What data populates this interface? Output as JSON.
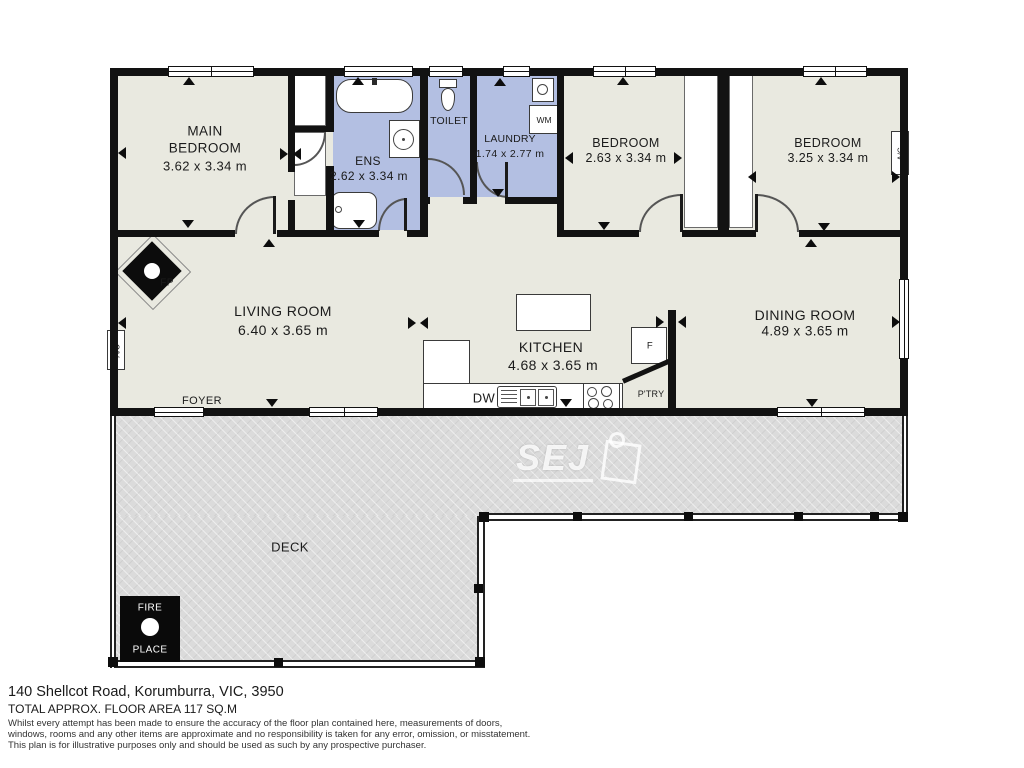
{
  "watermark": {
    "brand": "SEJ"
  },
  "rooms": {
    "main_bedroom": {
      "name_line1": "MAIN",
      "name_line2": "BEDROOM",
      "dims": "3.62 x 3.34 m"
    },
    "ens": {
      "name": "ENS",
      "dims": "2.62 x 3.34 m"
    },
    "toilet": {
      "name": "TOILET"
    },
    "laundry": {
      "name": "LAUNDRY",
      "dims": "1.74 x 2.77 m"
    },
    "bedroom2": {
      "name": "BEDROOM",
      "dims": "2.63 x 3.34 m"
    },
    "bedroom3": {
      "name": "BEDROOM",
      "dims": "3.25 x 3.34 m"
    },
    "living": {
      "name": "LIVING ROOM",
      "dims": "6.40 x 3.65 m"
    },
    "kitchen": {
      "name": "KITCHEN",
      "dims": "4.68 x 3.65 m"
    },
    "dining": {
      "name": "DINING ROOM",
      "dims": "4.89 x 3.65 m"
    },
    "foyer": {
      "name": "FOYER"
    },
    "deck": {
      "name": "DECK"
    }
  },
  "fixtures": {
    "fireplace_indoor": "FP",
    "fireplace_deck_line1": "FIRE",
    "fireplace_deck_line2": "PLACE",
    "ac": "A/C",
    "washing_machine": "WM",
    "dishwasher": "DW",
    "fridge": "F",
    "pantry": "P'TRY"
  },
  "footer": {
    "address": "140 Shellcot Road, Korumburra, VIC, 3950",
    "floor_area": "TOTAL APPROX. FLOOR AREA 117 SQ.M",
    "disclaimer_line1": "Whilst every attempt has been made to ensure the accuracy of the floor plan contained here, measurements of doors,",
    "disclaimer_line2": "windows, rooms and any other items are approximate and no responsibility is taken for any error, omission, or misstatement.",
    "disclaimer_line3": "This plan is for illustrative purposes only and should be used as such by any prospective purchaser."
  },
  "colors": {
    "wall": "#121212",
    "room_fill": "#e9e9e0",
    "wet_area": "#b3bfe2",
    "deck": "#dbdbdb"
  }
}
